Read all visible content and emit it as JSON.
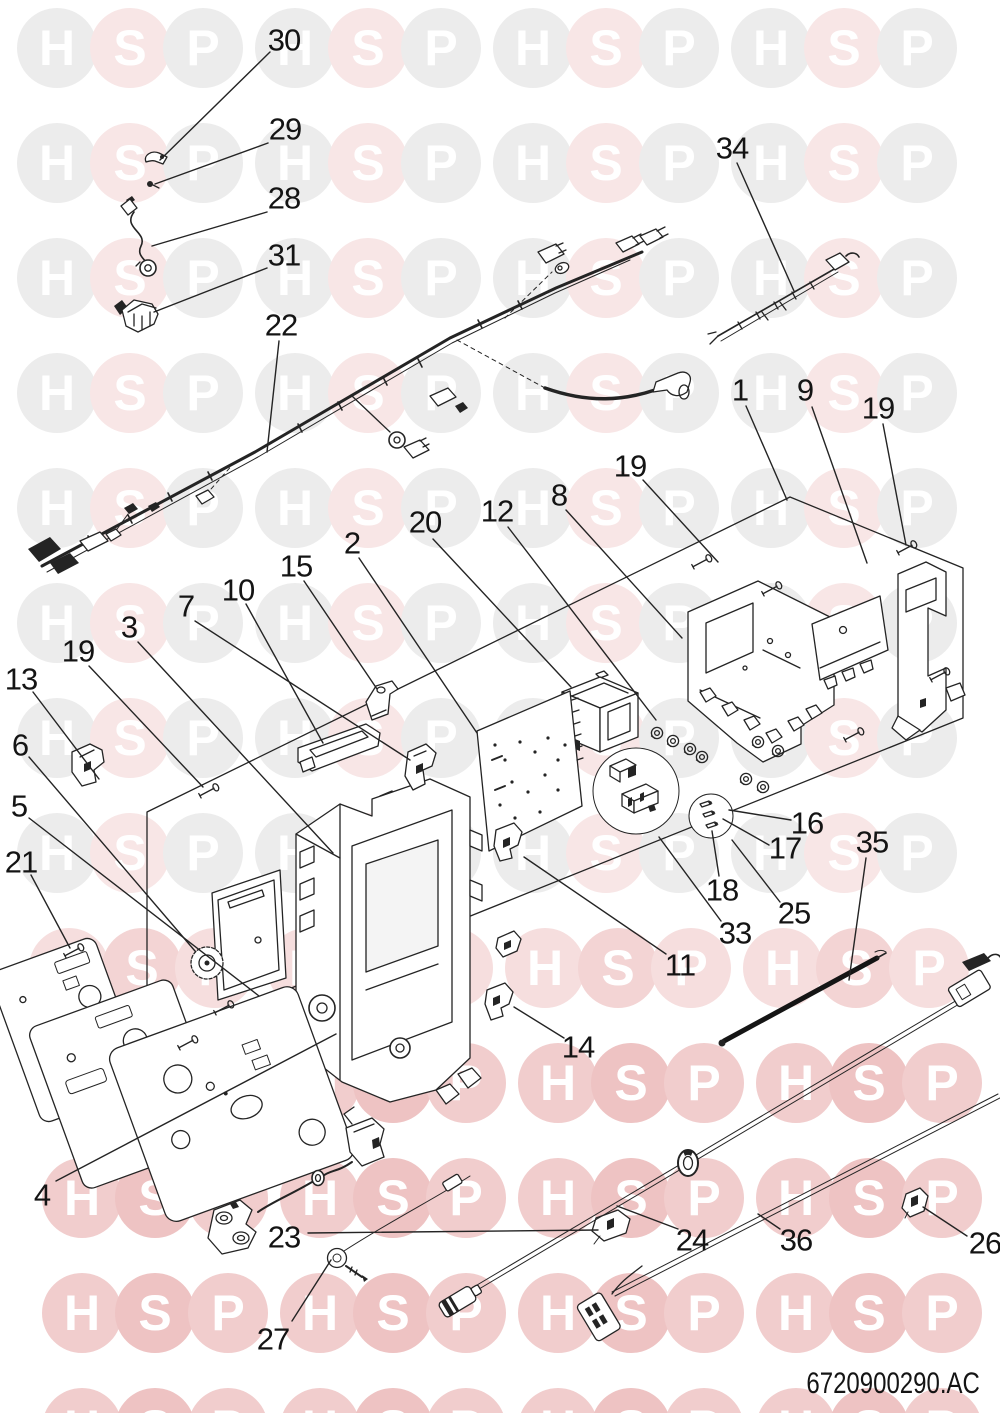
{
  "title": "boiler-control-box-exploded-parts-diagram",
  "doc_code": "6720900290.AC",
  "watermark": {
    "letters": [
      "H",
      "S",
      "P"
    ],
    "groups": 4,
    "group_start_x": 57,
    "group_step": 238,
    "letter_step": 73,
    "circle_diameter": 80,
    "letter_color": "#ffffff",
    "palettes": {
      "pale": {
        "H": "#ececec",
        "S": "#f8e6e6",
        "P": "#ececec"
      },
      "medium": {
        "H": "#f6dede",
        "S": "#f3d4d4",
        "P": "#f6dede"
      },
      "rose": {
        "H": "#f1cdcd",
        "S": "#eec3c3",
        "P": "#f1cdcd"
      }
    },
    "rows": [
      {
        "y": 48,
        "dx": 0,
        "palette": "pale"
      },
      {
        "y": 163,
        "dx": 0,
        "palette": "pale"
      },
      {
        "y": 278,
        "dx": 0,
        "palette": "pale"
      },
      {
        "y": 393,
        "dx": 0,
        "palette": "pale"
      },
      {
        "y": 508,
        "dx": 0,
        "palette": "pale"
      },
      {
        "y": 623,
        "dx": 0,
        "palette": "pale"
      },
      {
        "y": 738,
        "dx": 0,
        "palette": "pale"
      },
      {
        "y": 853,
        "dx": 0,
        "palette": "pale"
      },
      {
        "y": 968,
        "dx": 12,
        "palette": "medium"
      },
      {
        "y": 1083,
        "dx": 25,
        "palette": "rose"
      },
      {
        "y": 1198,
        "dx": 25,
        "palette": "rose"
      },
      {
        "y": 1313,
        "dx": 25,
        "palette": "rose"
      },
      {
        "y": 1428,
        "dx": 25,
        "palette": "rose"
      }
    ]
  },
  "callouts": [
    {
      "label": "30",
      "x": 284,
      "y": 40,
      "leader": [
        270,
        52,
        160,
        160
      ]
    },
    {
      "label": "29",
      "x": 285,
      "y": 129,
      "leader": [
        268,
        143,
        155,
        184
      ]
    },
    {
      "label": "28",
      "x": 284,
      "y": 198,
      "leader": [
        267,
        212,
        152,
        246
      ]
    },
    {
      "label": "31",
      "x": 284,
      "y": 255,
      "leader": [
        267,
        268,
        154,
        312
      ]
    },
    {
      "label": "22",
      "x": 281,
      "y": 325,
      "leader": [
        279,
        341,
        267,
        452
      ]
    },
    {
      "label": "34",
      "x": 732,
      "y": 148,
      "leader": [
        737,
        163,
        794,
        291
      ]
    },
    {
      "label": "1",
      "x": 740,
      "y": 390,
      "leader": [
        746,
        406,
        787,
        500
      ]
    },
    {
      "label": "9",
      "x": 805,
      "y": 390,
      "leader": [
        812,
        407,
        867,
        563
      ]
    },
    {
      "label": "19",
      "x": 878,
      "y": 408,
      "leader": [
        883,
        424,
        906,
        545
      ]
    },
    {
      "label": "19",
      "x": 630,
      "y": 466,
      "leader": [
        643,
        480,
        718,
        562
      ]
    },
    {
      "label": "8",
      "x": 559,
      "y": 495,
      "leader": [
        566,
        510,
        682,
        638
      ]
    },
    {
      "label": "12",
      "x": 497,
      "y": 511,
      "leader": [
        508,
        527,
        656,
        720
      ]
    },
    {
      "label": "20",
      "x": 425,
      "y": 522,
      "leader": [
        433,
        539,
        571,
        687
      ]
    },
    {
      "label": "2",
      "x": 352,
      "y": 543,
      "leader": [
        359,
        558,
        477,
        733
      ]
    },
    {
      "label": "15",
      "x": 296,
      "y": 566,
      "leader": [
        304,
        581,
        377,
        689
      ]
    },
    {
      "label": "10",
      "x": 238,
      "y": 590,
      "leader": [
        246,
        604,
        323,
        743
      ]
    },
    {
      "label": "7",
      "x": 186,
      "y": 606,
      "leader": [
        195,
        621,
        410,
        760
      ]
    },
    {
      "label": "3",
      "x": 129,
      "y": 627,
      "leader": [
        138,
        642,
        333,
        853
      ]
    },
    {
      "label": "19",
      "x": 78,
      "y": 651,
      "leader": [
        89,
        666,
        203,
        787
      ]
    },
    {
      "label": "13",
      "x": 21,
      "y": 679,
      "leader": [
        33,
        692,
        99,
        779
      ]
    },
    {
      "label": "6",
      "x": 20,
      "y": 745,
      "leader": [
        29,
        757,
        195,
        951
      ]
    },
    {
      "label": "5",
      "x": 19,
      "y": 806,
      "leader": [
        29,
        818,
        259,
        996
      ]
    },
    {
      "label": "21",
      "x": 21,
      "y": 862,
      "leader": [
        31,
        875,
        70,
        948
      ]
    },
    {
      "label": "16",
      "x": 807,
      "y": 823,
      "leader": [
        791,
        820,
        729,
        810
      ]
    },
    {
      "label": "17",
      "x": 785,
      "y": 848,
      "leader": [
        769,
        845,
        723,
        819
      ]
    },
    {
      "label": "18",
      "x": 722,
      "y": 890,
      "leader": [
        719,
        876,
        712,
        831
      ]
    },
    {
      "label": "25",
      "x": 794,
      "y": 913,
      "leader": [
        780,
        902,
        732,
        840
      ]
    },
    {
      "label": "33",
      "x": 735,
      "y": 933,
      "leader": [
        721,
        921,
        659,
        837
      ]
    },
    {
      "label": "11",
      "x": 680,
      "y": 965,
      "leader": [
        666,
        954,
        524,
        857
      ]
    },
    {
      "label": "35",
      "x": 872,
      "y": 842,
      "leader": [
        866,
        858,
        849,
        980
      ]
    },
    {
      "label": "14",
      "x": 578,
      "y": 1047,
      "leader": [
        564,
        1038,
        514,
        1007
      ]
    },
    {
      "label": "4",
      "x": 42,
      "y": 1195,
      "leader": [
        56,
        1181,
        336,
        1034
      ]
    },
    {
      "label": "23",
      "x": 284,
      "y": 1237,
      "leader": [
        308,
        1233,
        598,
        1230
      ]
    },
    {
      "label": "27",
      "x": 273,
      "y": 1339,
      "leader": [
        292,
        1321,
        331,
        1260
      ]
    },
    {
      "label": "24",
      "x": 692,
      "y": 1240,
      "leader": [
        678,
        1229,
        617,
        1206
      ]
    },
    {
      "label": "36",
      "x": 796,
      "y": 1240,
      "leader": [
        780,
        1229,
        758,
        1214
      ]
    },
    {
      "label": "26",
      "x": 985,
      "y": 1243,
      "leader": [
        967,
        1236,
        923,
        1207
      ]
    }
  ],
  "hardware": {
    "screws": [
      [
        700,
        563
      ],
      [
        905,
        549
      ],
      [
        770,
        590
      ],
      [
        938,
        676
      ],
      [
        852,
        736
      ],
      [
        207,
        792
      ],
      [
        72,
        952
      ],
      [
        222,
        1009
      ],
      [
        186,
        1044
      ]
    ],
    "grommets": [
      [
        657,
        733
      ],
      [
        673,
        741
      ],
      [
        690,
        749
      ],
      [
        702,
        757
      ],
      [
        746,
        779
      ],
      [
        763,
        787
      ],
      [
        758,
        742
      ],
      [
        778,
        751
      ]
    ]
  }
}
